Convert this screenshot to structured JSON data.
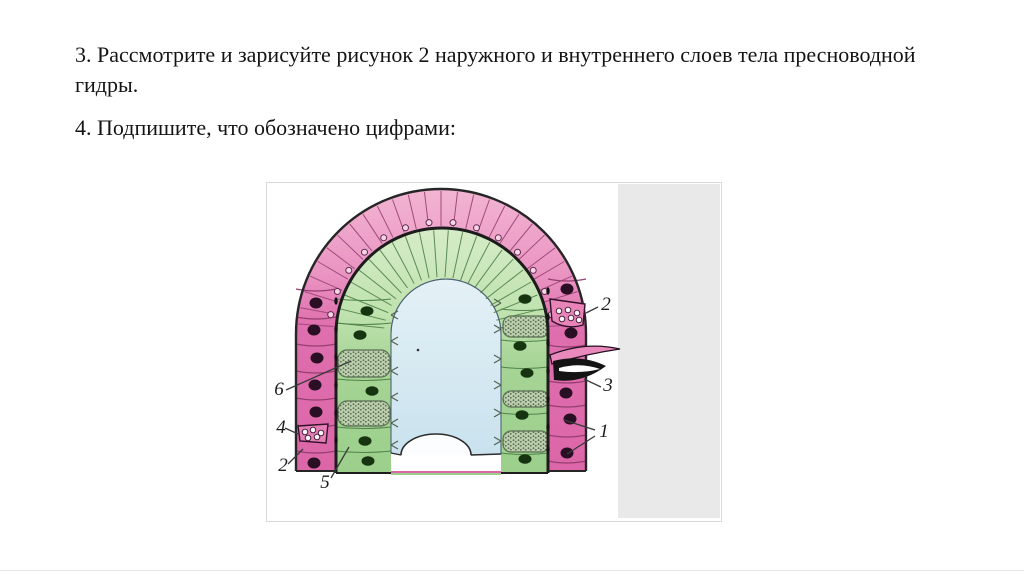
{
  "slide": {
    "background": "#ffffff",
    "task3_line": "3. Рассмотрите и зарисуйте рисунок 2 наружного и внутреннего слоев тела пресноводной гидры.",
    "task4_line": "4. Подпишите, что обозначено цифрами:"
  },
  "figure": {
    "type": "labeled-biology-diagram",
    "labels": [
      {
        "text": "2"
      },
      {
        "text": "3"
      },
      {
        "text": "1"
      },
      {
        "text": "6"
      },
      {
        "text": "4"
      },
      {
        "text": "2"
      },
      {
        "text": "5"
      }
    ],
    "colors": {
      "ectoderm_pink": "#dc66a8",
      "ectoderm_pink_light": "#f2b5d2",
      "endoderm_green": "#a6d496",
      "endoderm_green_light": "#d6ecc8",
      "cavity_blue_top": "#e4f1f6",
      "cavity_blue_bottom": "#c9e2ee",
      "outline_dark": "#222222",
      "nucleus_dark": "#2a0f24",
      "nucleus_green": "#15340f",
      "stipple_bg": "#bccfae",
      "stipple_dot": "#5c6f53",
      "gray_panel": "#e9e9ea",
      "image_border": "#dadada"
    }
  }
}
